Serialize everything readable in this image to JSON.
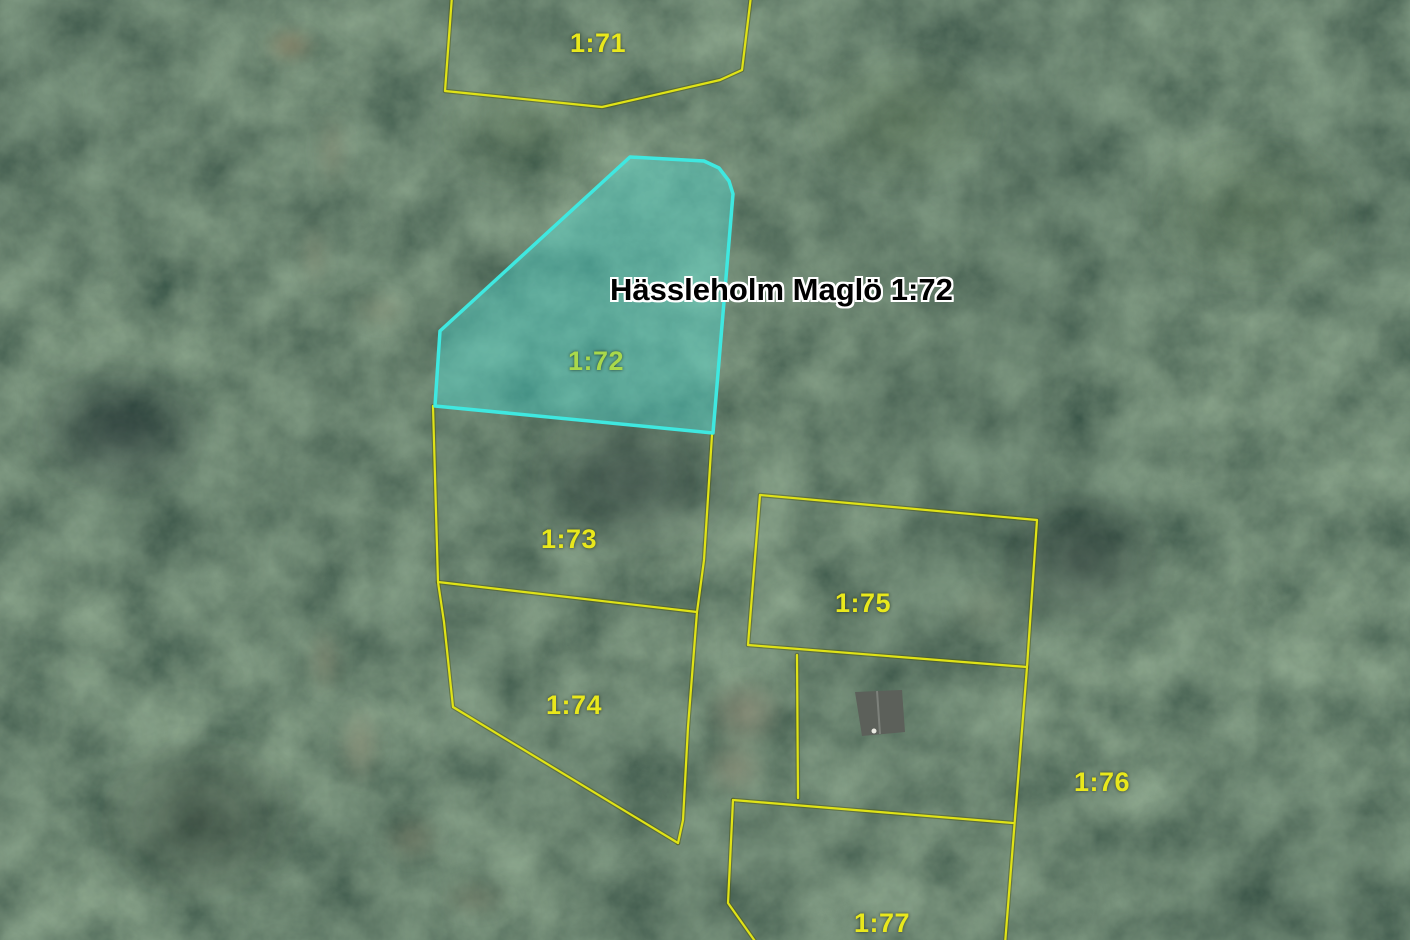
{
  "map": {
    "annotation": {
      "text": "Hässleholm Maglö 1:72"
    },
    "selected_parcel": {
      "id": "1-72",
      "points": "630,157 704,161 719,168 729,181 733,194 713,433 435,406 440,331",
      "fill": "rgba(72,230,222,0.38)",
      "stroke": "#3fe8e0",
      "label": "1:72"
    },
    "parcel_labels": [
      {
        "id": "1-71",
        "label": "1:71",
        "x": 570,
        "y": 28
      },
      {
        "id": "1-72",
        "label": "1:72",
        "x": 568,
        "y": 346,
        "color": "#a9d94b"
      },
      {
        "id": "1-73",
        "label": "1:73",
        "x": 541,
        "y": 524
      },
      {
        "id": "1-74",
        "label": "1:74",
        "x": 546,
        "y": 690
      },
      {
        "id": "1-75",
        "label": "1:75",
        "x": 835,
        "y": 588
      },
      {
        "id": "1-76",
        "label": "1:76",
        "x": 1074,
        "y": 767
      },
      {
        "id": "1-77",
        "label": "1:77",
        "x": 854,
        "y": 908
      }
    ],
    "boundaries": [
      {
        "id": "1-71",
        "points": "452,-4 445,91 602,107 720,80 742,70 751,-4",
        "closed": false
      },
      {
        "id": "west-73-74",
        "points": "433,406 438,582 444,622 453,707 678,843",
        "closed": false
      },
      {
        "id": "divider-73-74",
        "points": "438,582 697,612",
        "closed": false
      },
      {
        "id": "east-73-74",
        "points": "712,435 704,560 697,612 688,727 683,820 678,843",
        "closed": false
      },
      {
        "id": "1-75",
        "points": "760,495 1037,520 1027,667 748,645",
        "closed": true
      },
      {
        "id": "branch-75-south",
        "points": "797,655 798,798",
        "closed": false
      },
      {
        "id": "south-house-lot",
        "points": "733,800 1013,823",
        "closed": false
      },
      {
        "id": "west-1-77",
        "points": "733,800 728,903 757,944",
        "closed": false
      },
      {
        "id": "east-right",
        "points": "1027,667 1015,818 1005,944",
        "closed": false
      }
    ],
    "house": {
      "roof_points": "855,692 902,690 905,732 862,736",
      "ridge_points": "877,691 880,734",
      "roof_color": "#5c605a",
      "ridge_color": "#7c807a",
      "dot": {
        "cx": 874,
        "cy": 731,
        "r": 2.5
      },
      "dot_color": "#eaeae2"
    },
    "style": {
      "boundary_color": "#e0e316",
      "boundary_halo": "#4a5208",
      "label_color": "#e9e81c",
      "title_color": "#000000",
      "title_halo": "#ffffff",
      "base_terrain": "#223826"
    }
  }
}
